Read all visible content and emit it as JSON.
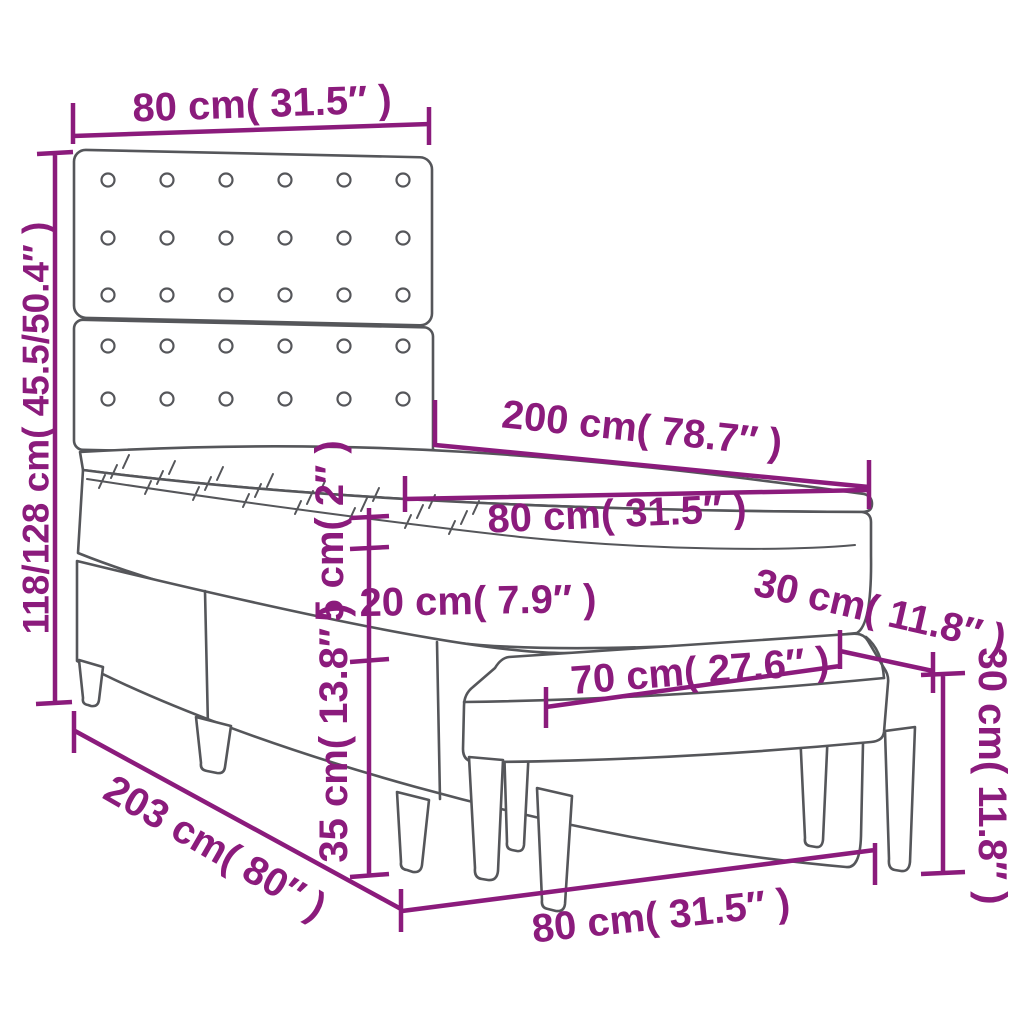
{
  "figure": {
    "kind": "furniture dimension line drawing",
    "accent_color": "#8B1B7C",
    "line_color": "#55565A",
    "background_color": "#FFFFFF"
  },
  "headboard": {
    "button_columns": 6,
    "button_rows_top_panel": 3,
    "button_rows_bottom_panel": 2
  },
  "dimensions": {
    "headboard_width": {
      "label": "80 cm( 31.5″ )",
      "cm": "80",
      "inch": "31.5"
    },
    "total_height": {
      "label": "118/128 cm( 45.5/50.4″ )",
      "cm": "118/128",
      "inch": "45.5/50.4"
    },
    "bed_length": {
      "label": "200 cm( 78.7″ )",
      "cm": "200",
      "inch": "78.7"
    },
    "mattress_width": {
      "label": "80 cm( 31.5″ )",
      "cm": "80",
      "inch": "31.5"
    },
    "topper_height": {
      "label": "5 cm( 2″ )",
      "cm": "5",
      "inch": "2"
    },
    "mattress_height": {
      "label": "20 cm( 7.9″ )",
      "cm": "20",
      "inch": "7.9"
    },
    "base_height": {
      "label": "35 cm( 13.8″ )",
      "cm": "35",
      "inch": "13.8"
    },
    "bench_depth": {
      "label": "30 cm( 11.8″ )",
      "cm": "30",
      "inch": "11.8"
    },
    "bench_length": {
      "label": "70 cm( 27.6″ )",
      "cm": "70",
      "inch": "27.6"
    },
    "bench_height": {
      "label": "30 cm( 11.8″ )",
      "cm": "30",
      "inch": "11.8"
    },
    "total_length": {
      "label": "203 cm( 80″ )",
      "cm": "203",
      "inch": "80"
    },
    "bench_width": {
      "label": "80 cm( 31.5″ )",
      "cm": "80",
      "inch": "31.5"
    }
  }
}
